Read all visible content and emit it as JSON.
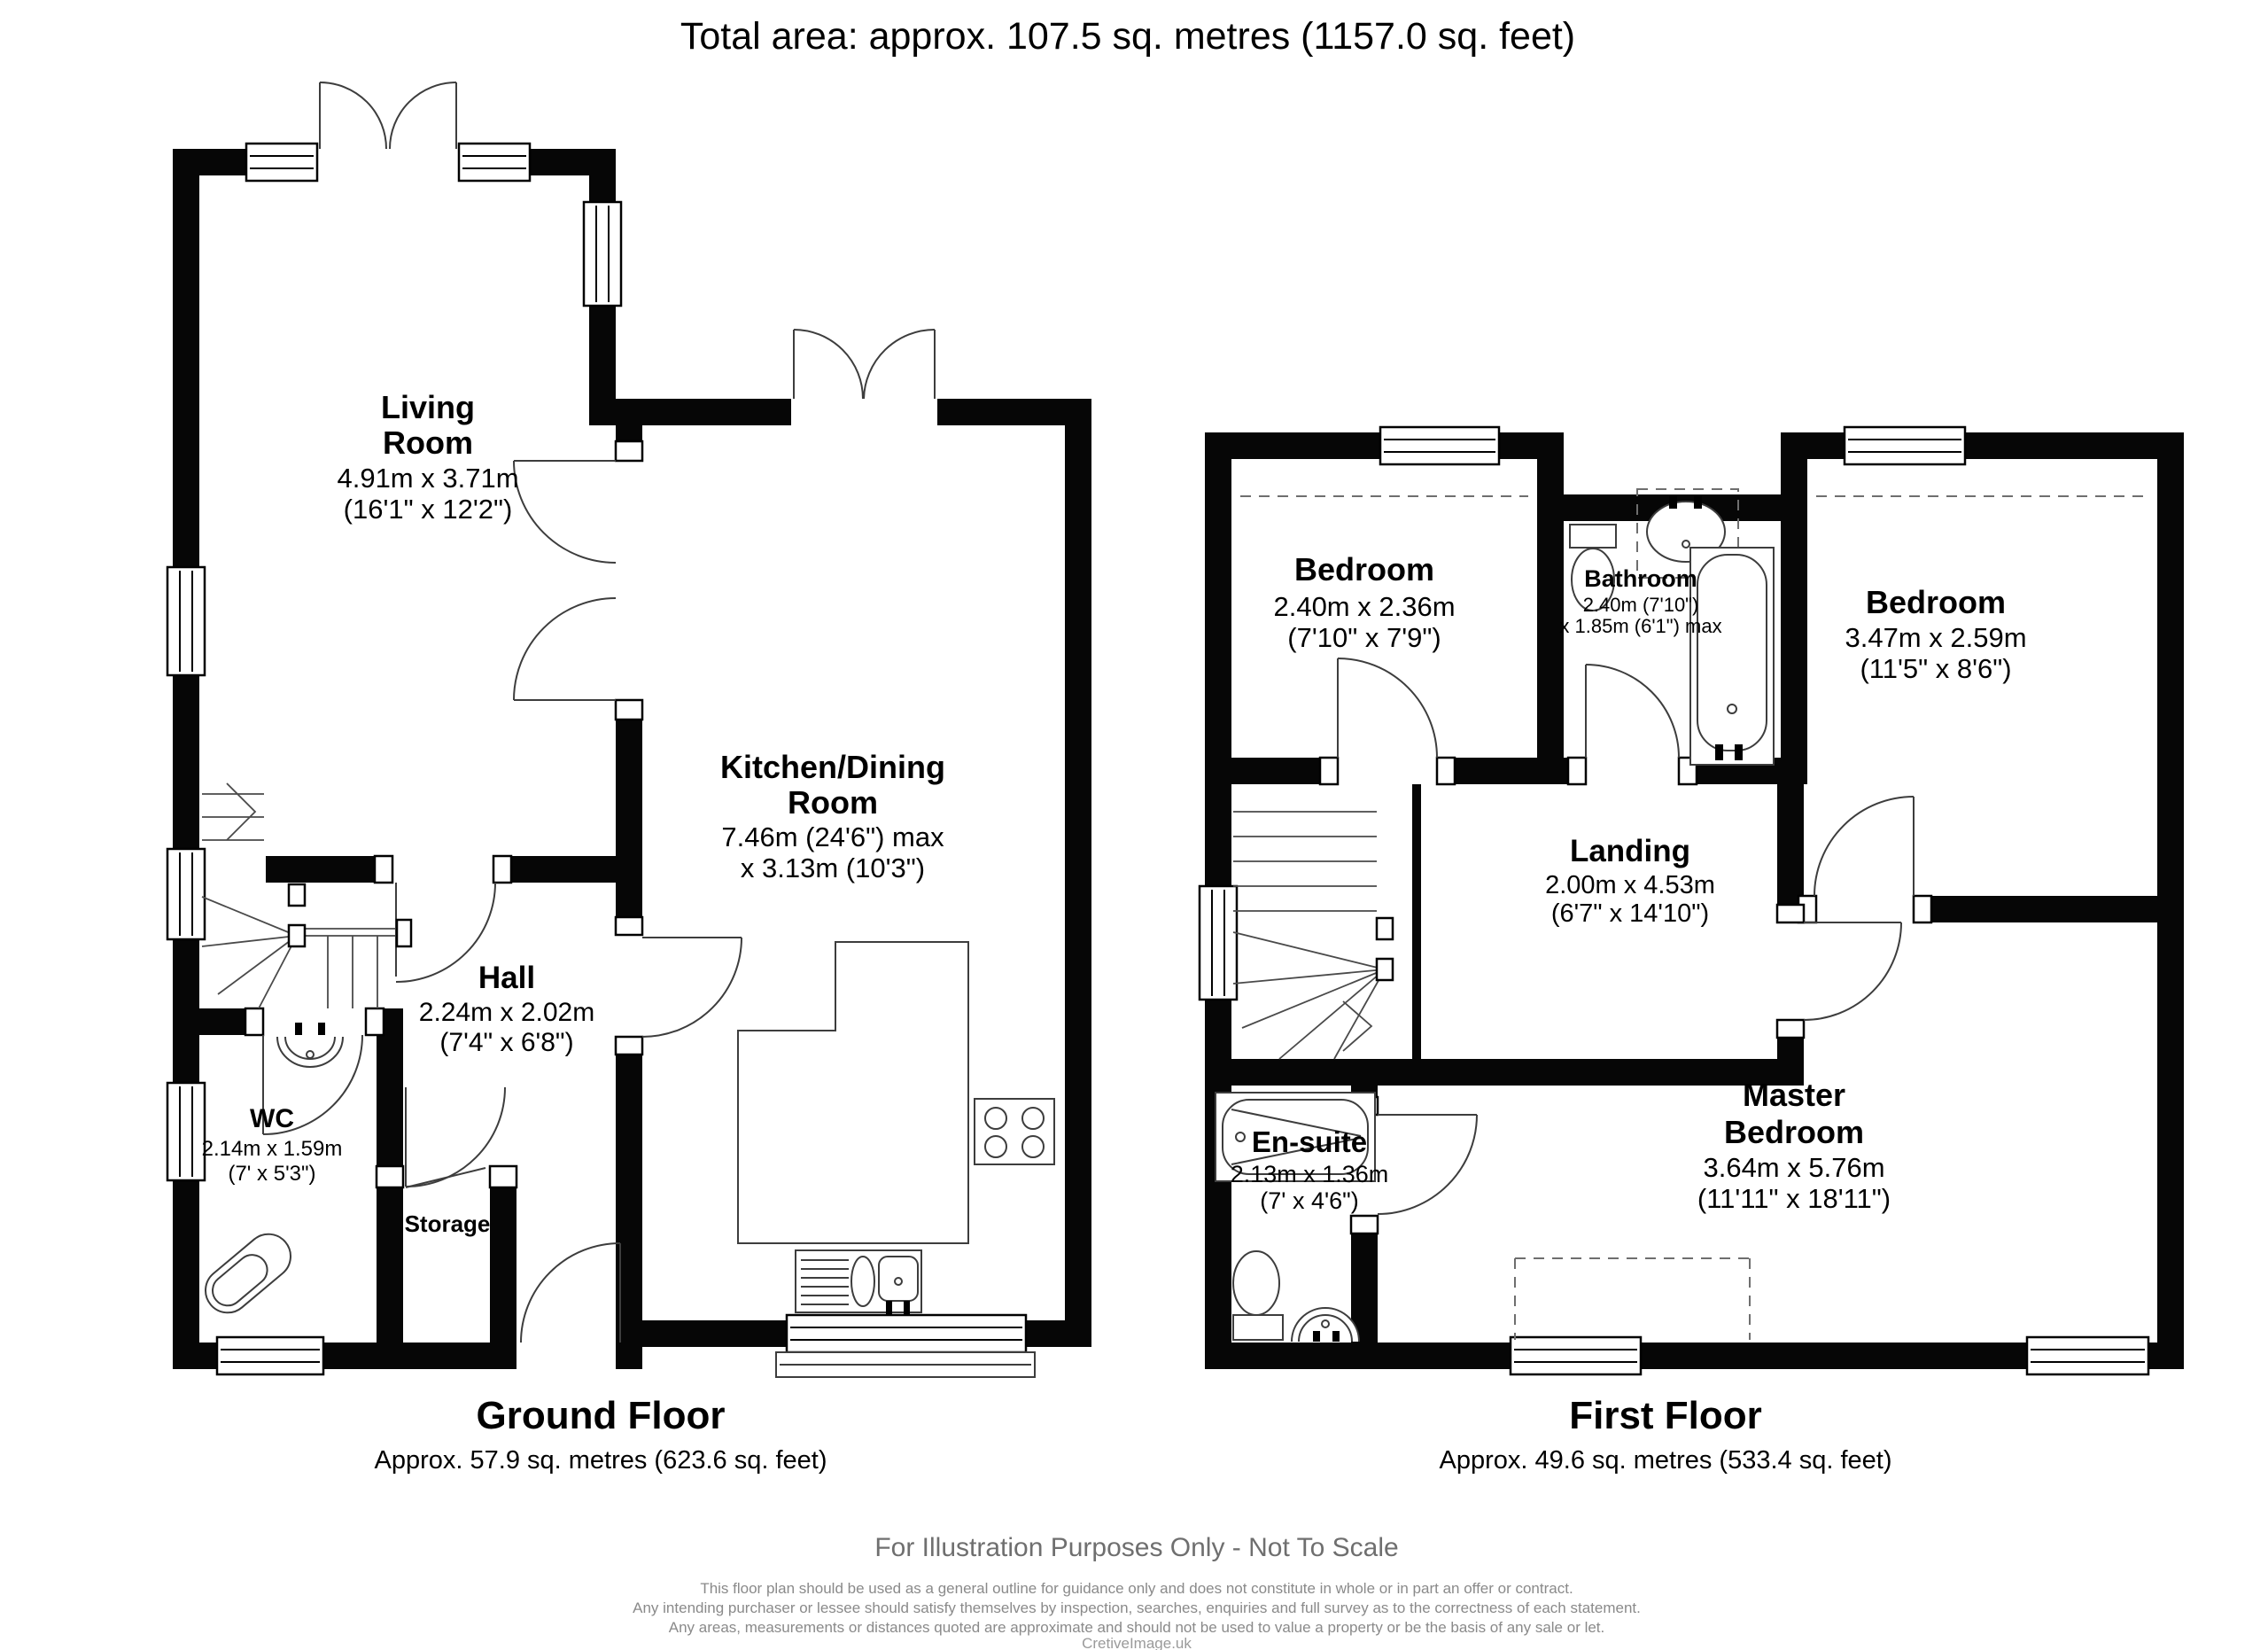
{
  "title": "Total area: approx. 107.5 sq. metres (1157.0 sq. feet)",
  "ground": {
    "title": "Ground Floor",
    "area": "Approx. 57.9 sq. metres (623.6 sq. feet)",
    "rooms": {
      "living": {
        "line1": "Living",
        "line2": "Room",
        "metric": "4.91m x 3.71m",
        "imperial": "(16'1\" x 12'2\")"
      },
      "kitchen": {
        "line1": "Kitchen/Dining",
        "line2": "Room",
        "metric": "7.46m (24'6\") max",
        "imperial": "x 3.13m (10'3\")"
      },
      "hall": {
        "name": "Hall",
        "metric": "2.24m x 2.02m",
        "imperial": "(7'4\" x 6'8\")"
      },
      "wc": {
        "name": "WC",
        "metric": "2.14m x 1.59m",
        "imperial": "(7' x 5'3\")"
      },
      "storage": {
        "name": "Storage"
      }
    }
  },
  "first": {
    "title": "First Floor",
    "area": "Approx. 49.6 sq. metres (533.4 sq. feet)",
    "rooms": {
      "bedroom_left": {
        "name": "Bedroom",
        "metric": "2.40m x 2.36m",
        "imperial": "(7'10\" x 7'9\")"
      },
      "bathroom": {
        "name": "Bathroom",
        "metric": "2.40m (7'10\")",
        "imperial": "x 1.85m (6'1\") max"
      },
      "bedroom_right": {
        "name": "Bedroom",
        "metric": "3.47m x 2.59m",
        "imperial": "(11'5\" x 8'6\")"
      },
      "landing": {
        "name": "Landing",
        "metric": "2.00m x 4.53m",
        "imperial": "(6'7\" x 14'10\")"
      },
      "ensuite": {
        "name": "En-suite",
        "metric": "2.13m x 1.36m",
        "imperial": "(7' x 4'6\")"
      },
      "master": {
        "line1": "Master",
        "line2": "Bedroom",
        "metric": "3.64m x 5.76m",
        "imperial": "(11'11\" x 18'11\")"
      }
    }
  },
  "footer": {
    "notice": "For Illustration Purposes Only - Not To Scale",
    "line1": "This floor plan should be used as a general outline for guidance only and does not constitute in whole or in part an offer or contract.",
    "line2": "Any intending purchaser or lessee should satisfy themselves by inspection, searches, enquiries and full survey as to the correctness of each statement.",
    "line3": "Any areas, measurements or distances quoted are approximate and should not be used to value a property or be the basis of any sale or let.",
    "credit": "CretiveImage.uk"
  },
  "colors": {
    "wall": "#060606",
    "line": "#3d3d3d",
    "muted": "#8a8a8a",
    "background": "#ffffff"
  }
}
